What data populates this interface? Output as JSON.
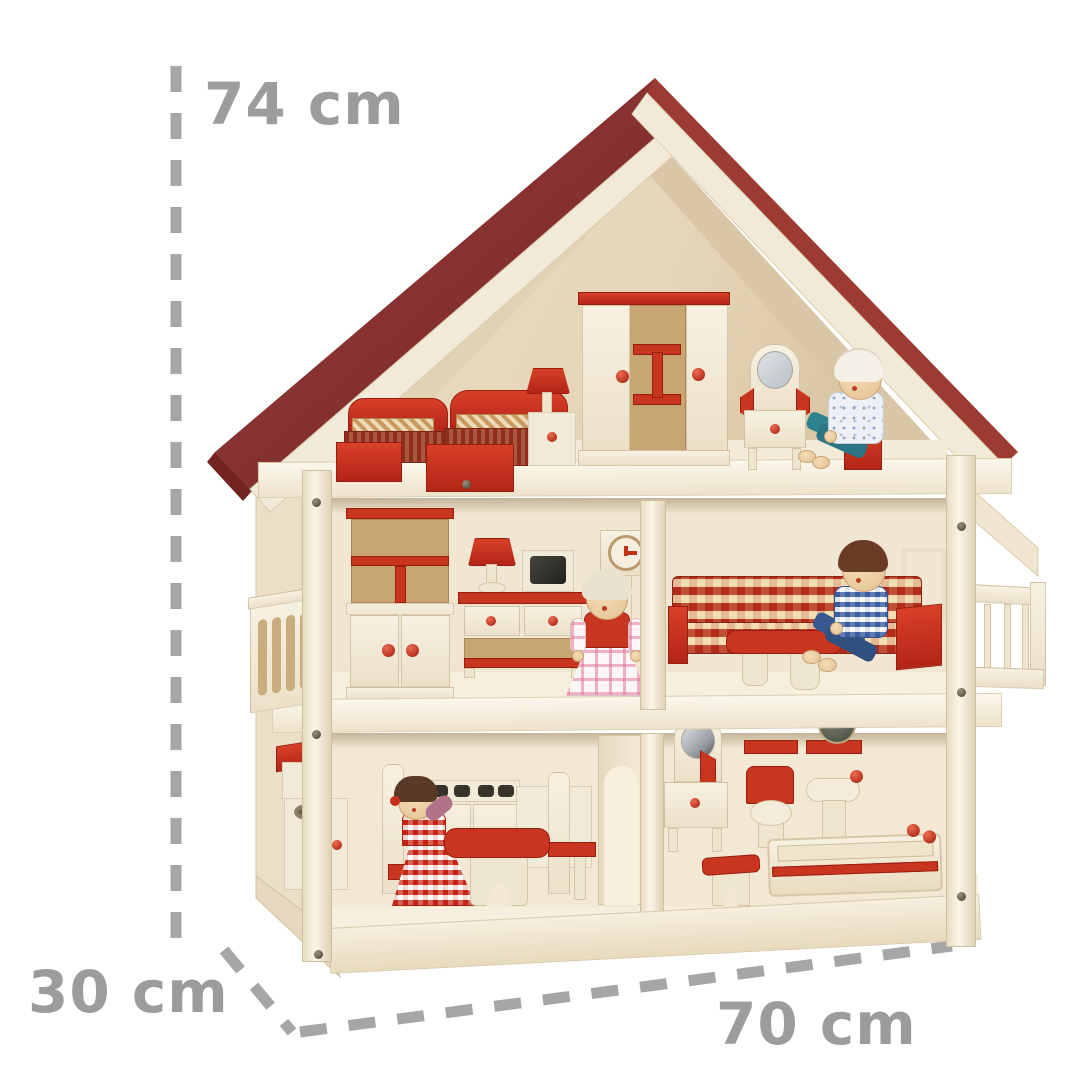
{
  "image": {
    "type": "product-photo",
    "subject": "three-storey wooden dollhouse with red roof, furniture and four dolls",
    "background_color": "#ffffff"
  },
  "dimensions": {
    "height_label": "74 cm",
    "depth_label": "30 cm",
    "width_label": "70 cm",
    "label_color": "#9c9c9c",
    "line_style": "thick gray dashes"
  },
  "colors": {
    "roof_red": "#87302c",
    "accent_red": "#c93620",
    "wood_light": "#f2ead8",
    "wood_mid": "#e9dcc2",
    "panel_tan": "#c8a672",
    "wall_cream": "#f1e6d1",
    "label_gray": "#9c9c9c"
  },
  "house": {
    "floors": [
      {
        "name": "attic bedroom",
        "items": [
          "bed with striped blanket",
          "second bed with striped blanket",
          "nightstand with red lamp",
          "wardrobe with red trim",
          "dressing table with round mirror",
          "grandpa doll on red stool"
        ]
      },
      {
        "name": "middle living floor",
        "items": [
          "left balcony with oval-slot railing",
          "tall cabinet",
          "sideboard",
          "red table lamp",
          "television",
          "wall clock",
          "grandma doll",
          "red gingham corner sofa",
          "red coffee table",
          "dad doll",
          "right balcony with spindle railing"
        ]
      },
      {
        "name": "ground floor",
        "items": [
          "kitchen cupboard with red top",
          "sink cabinet",
          "mom doll on chair",
          "stove with burners",
          "kitchen cupboard",
          "red dining table",
          "chair",
          "arched doorway",
          "bathroom vanity with mirror",
          "red wall rails",
          "round wall mirror",
          "toilet with red lid",
          "pedestal washbasin",
          "bathtub with red stripe",
          "stool with red seat"
        ]
      }
    ]
  }
}
